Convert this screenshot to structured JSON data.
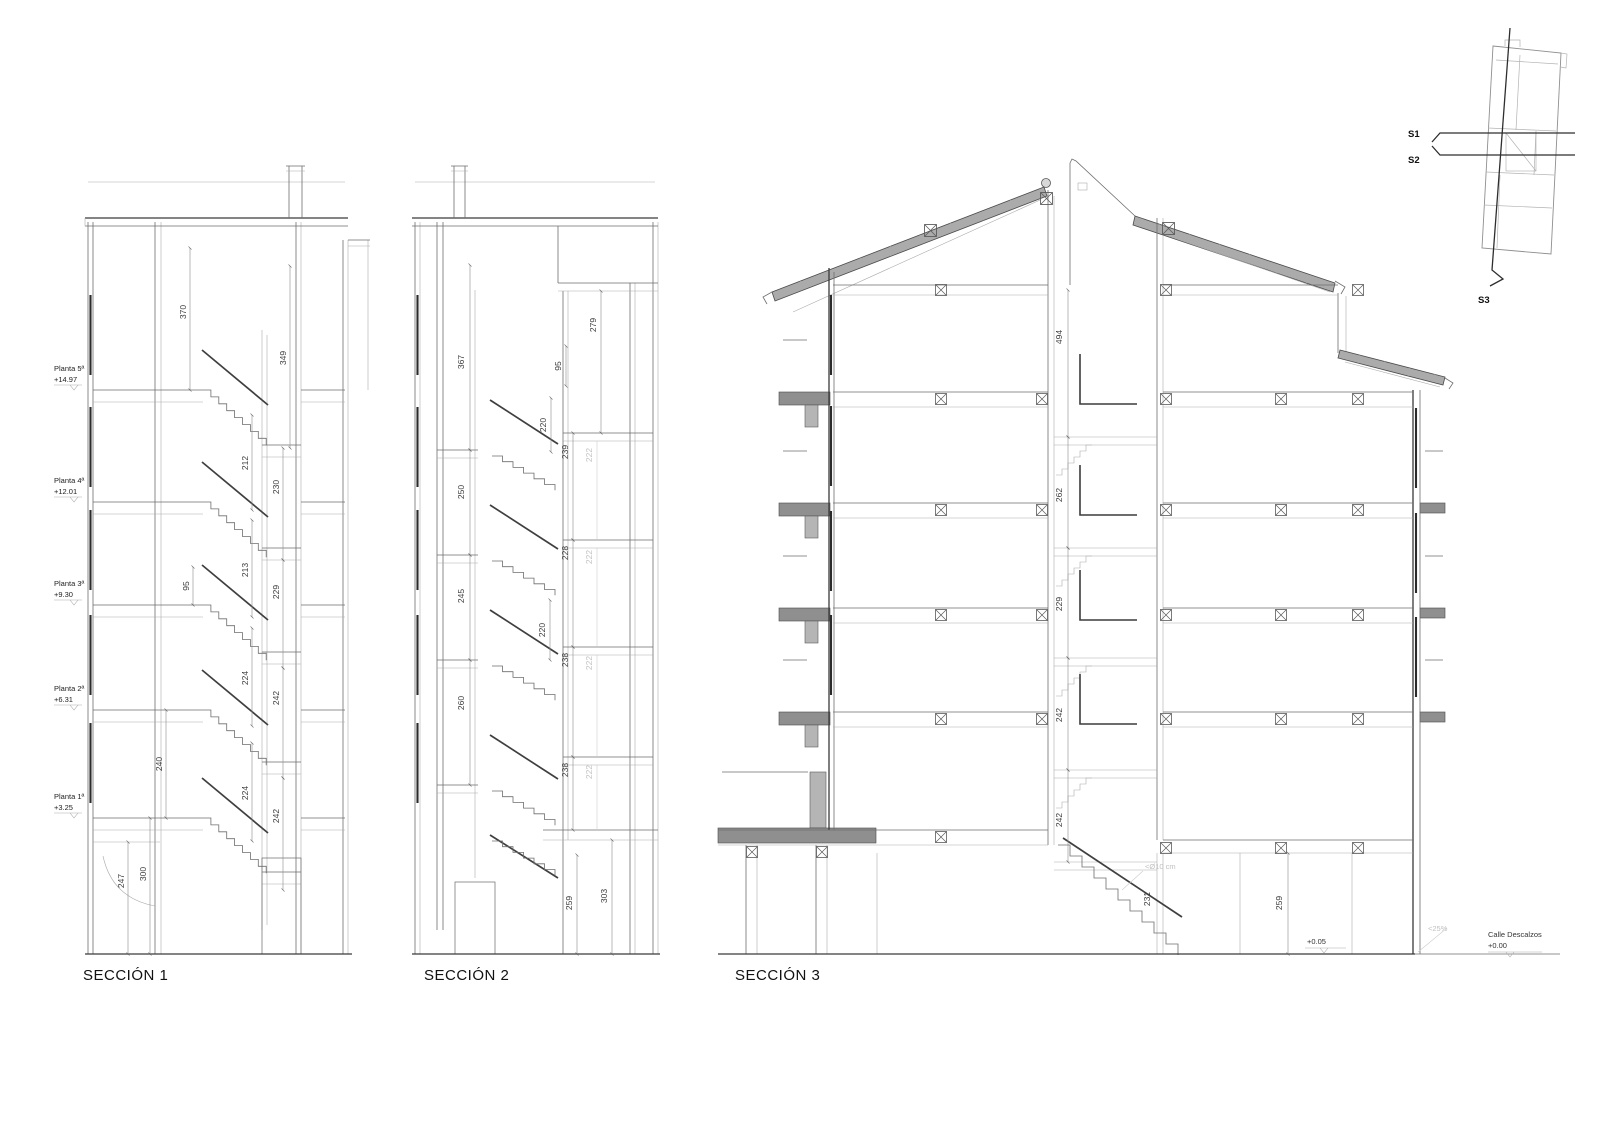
{
  "titles": {
    "s1": "SECCIÓN 1",
    "s2": "SECCIÓN 2",
    "s3": "SECCIÓN 3"
  },
  "section1": {
    "floors": [
      {
        "name": "Planta 5ª",
        "elev": "+14.97"
      },
      {
        "name": "Planta 4ª",
        "elev": "+12.01"
      },
      {
        "name": "Planta 3ª",
        "elev": "+9.30"
      },
      {
        "name": "Planta 2ª",
        "elev": "+6.31"
      },
      {
        "name": "Planta 1ª",
        "elev": "+3.25"
      }
    ],
    "dims": {
      "h370": "370",
      "h349": "349",
      "h212": "212",
      "h230": "230",
      "h95": "95",
      "h213": "213",
      "h229": "229",
      "h224a": "224",
      "h242a": "242",
      "h240": "240",
      "h224b": "224",
      "h242b": "242",
      "h247": "247",
      "h300": "300"
    }
  },
  "section2": {
    "dims": {
      "h367": "367",
      "h279": "279",
      "h95": "95",
      "h220a": "220",
      "h239": "239",
      "h250": "250",
      "h228": "228",
      "h245": "245",
      "h220b": "220",
      "h238a": "238",
      "h260": "260",
      "h238b": "238",
      "h259": "259",
      "h303": "303"
    },
    "gray_dims": {
      "g222a": "222",
      "g222b": "222",
      "g222c": "222",
      "g222d": "222"
    }
  },
  "section3": {
    "dims": {
      "h494": "494",
      "h262": "262",
      "h229": "229",
      "h242a": "242",
      "h242b": "242",
      "h231": "231",
      "h259": "259"
    },
    "notes": {
      "pipe": "<Ø10 cm",
      "slope": "<25%",
      "entry_level": "+0.05",
      "street_name": "Calle Descalzos",
      "street_level": "+0.00"
    }
  },
  "key_plan": {
    "s1": "S1",
    "s2": "S2",
    "s3": "S3"
  }
}
